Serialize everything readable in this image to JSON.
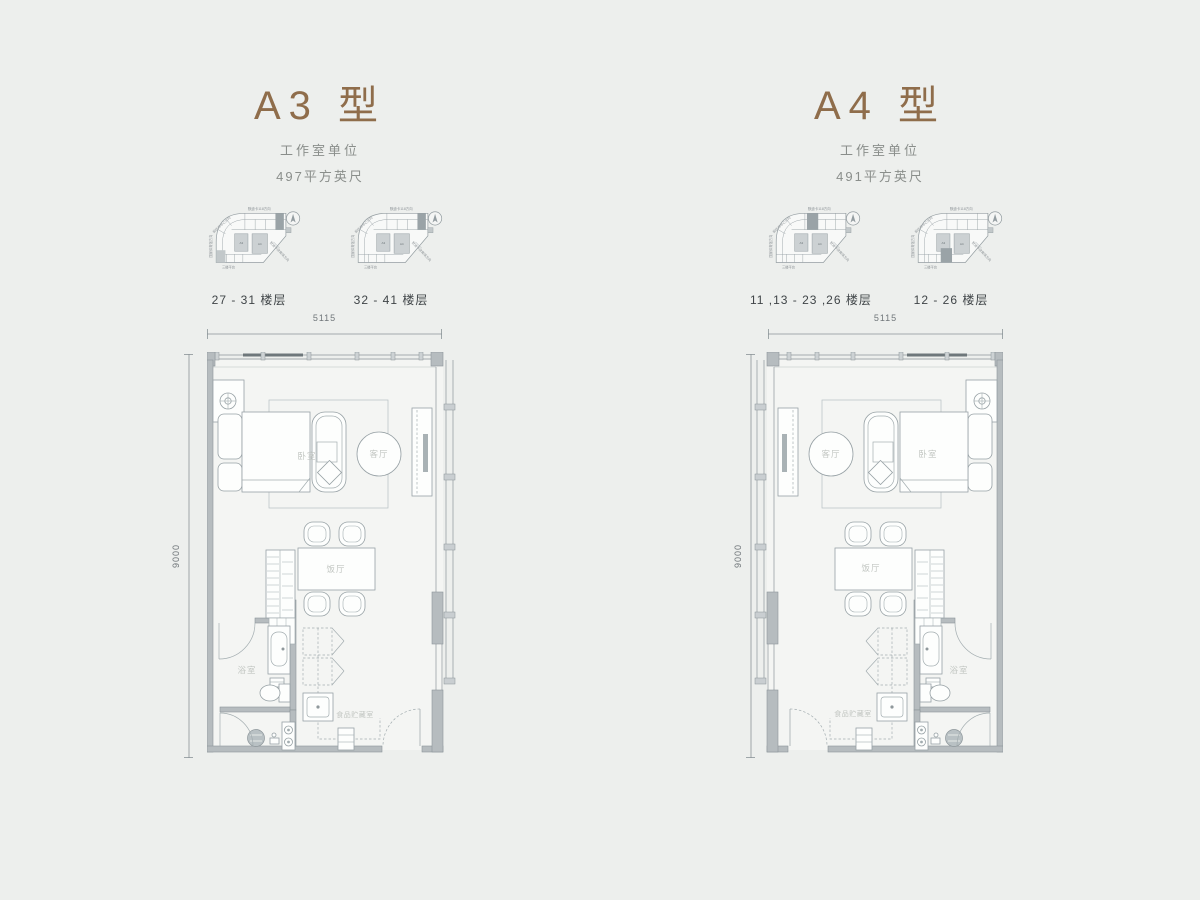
{
  "page": {
    "background": "#edefed"
  },
  "keyplan_labels": {
    "top": "默迪卡118方向",
    "upper_left": "前往市中心方向",
    "left": "国家体育馆方向",
    "lower_right": "默迪卡体育场方向",
    "bottom": "三楼平台",
    "cell_a": "A3",
    "cell_b": "A4"
  },
  "units": [
    {
      "id": "A3",
      "title": "A3 型",
      "subtitle": "工作室单位",
      "area": "497平方英尺",
      "keyplans": [
        {
          "caption": "27 - 31 楼层"
        },
        {
          "caption": "32 - 41 楼层"
        }
      ],
      "dims": {
        "width": "5115",
        "height": "9000"
      },
      "rooms": {
        "bedroom": "卧室",
        "living": "客厅",
        "dining": "饭厅",
        "bath": "浴室",
        "pantry": "食品贮藏室"
      }
    },
    {
      "id": "A4",
      "title": "A4 型",
      "subtitle": "工作室单位",
      "area": "491平方英尺",
      "keyplans": [
        {
          "caption": "11 ,13 - 23 ,26 楼层"
        },
        {
          "caption": "12 - 26 楼层"
        }
      ],
      "dims": {
        "width": "5115",
        "height": "9000"
      },
      "rooms": {
        "bedroom": "卧室",
        "living": "客厅",
        "dining": "饭厅",
        "bath": "浴室",
        "pantry": "食品贮藏室"
      }
    }
  ],
  "colors": {
    "accent": "#8f6d4b",
    "wall": "#b6bcbf",
    "line": "#97a1a5",
    "room_label": "#c2c6c2",
    "caption": "#3f4447",
    "dim": "#70767a"
  }
}
